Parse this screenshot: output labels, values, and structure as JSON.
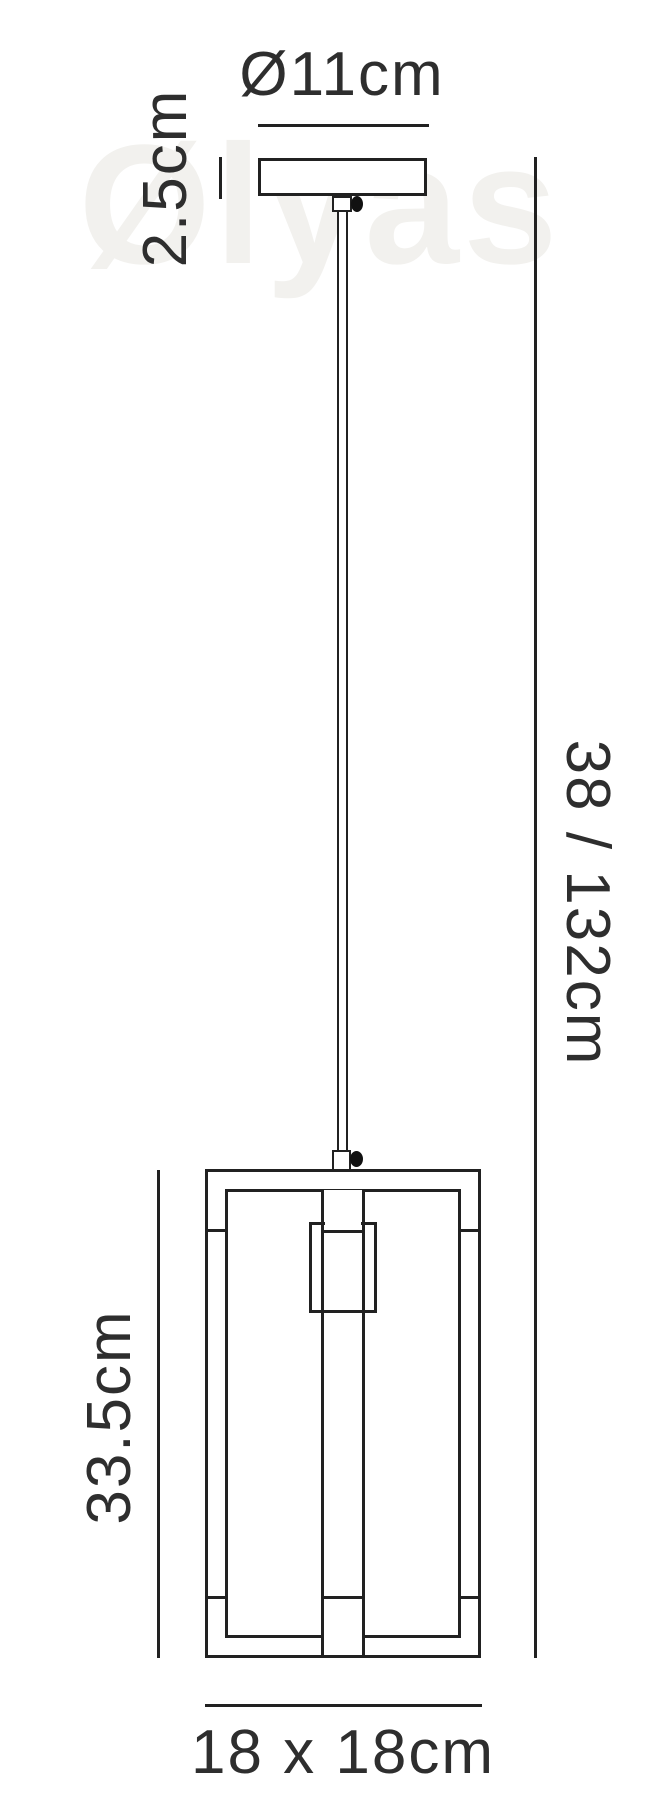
{
  "watermark": {
    "text": "Ølyas"
  },
  "colors": {
    "line": "#212121",
    "text": "#2e2e2e",
    "knob": "#111111",
    "watermark": "#f2f1ee",
    "background": "#ffffff"
  },
  "labels": {
    "canopy_diameter": "Ø11cm",
    "canopy_height": "2.5cm",
    "drop_height": "38 / 132cm",
    "body_height": "33.5cm",
    "base_size": "18 x 18cm"
  }
}
